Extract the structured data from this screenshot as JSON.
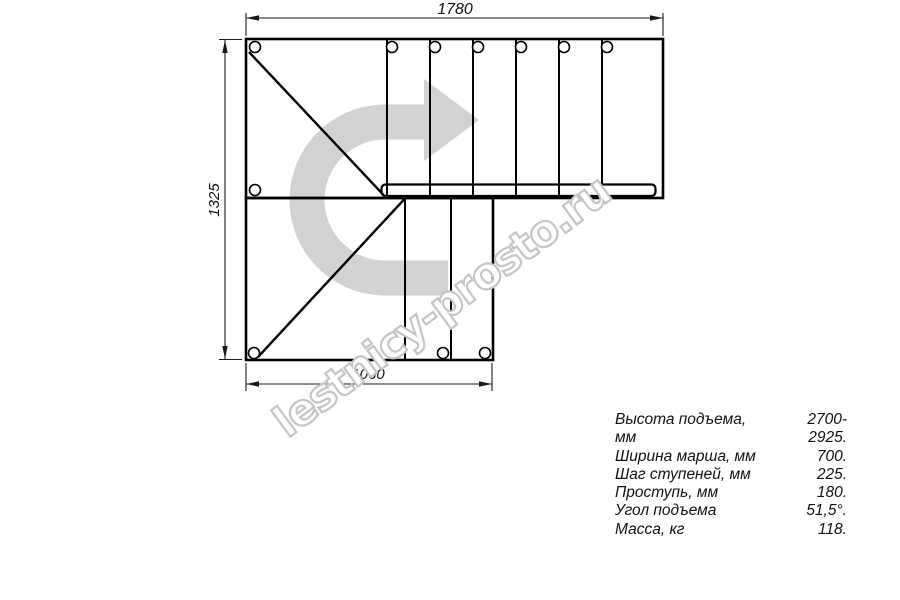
{
  "drawing": {
    "dim_top": "1780",
    "dim_left": "1325",
    "dim_bottom": "1060"
  },
  "watermark": {
    "text": "lestnicy-prosto.ru"
  },
  "specs": {
    "rows": [
      {
        "label": "Высота подъема, мм",
        "value": "2700-2925."
      },
      {
        "label": "Ширина марша, мм",
        "value": "700."
      },
      {
        "label": "Шаг ступеней, мм",
        "value": "225."
      },
      {
        "label": "Проступь, мм",
        "value": "180."
      },
      {
        "label": "Угол подъема",
        "value": "51,5°."
      },
      {
        "label": "Масса, кг",
        "value": "118."
      }
    ]
  },
  "colors": {
    "line": "#000000",
    "dimension": "#1a1a1a",
    "arrow_fill": "#d2d2d2",
    "watermark_outline": "#c5c5c5"
  }
}
